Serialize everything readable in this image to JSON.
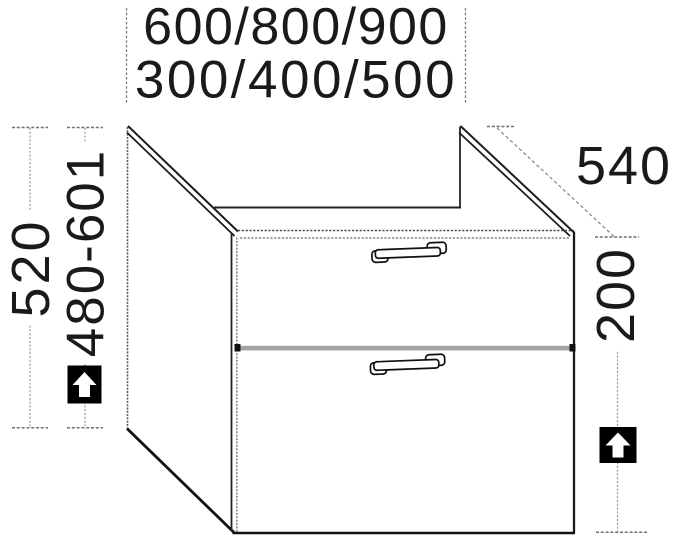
{
  "dimensions": {
    "width_options": "600/800/900",
    "width_options_secondary": "300/400/500",
    "height": "520",
    "height_range": "480-601",
    "depth": "540",
    "drawer_front_height": "200"
  },
  "icons": {
    "height_adjust_left": "up-arrow",
    "height_adjust_right": "up-arrow"
  },
  "colors": {
    "line_dark": "#1c1c1c",
    "line_dim": "#909090",
    "divider_fill": "#a3a3a3",
    "icon_background": "#000000",
    "icon_arrow": "#ffffff",
    "background": "#ffffff"
  }
}
